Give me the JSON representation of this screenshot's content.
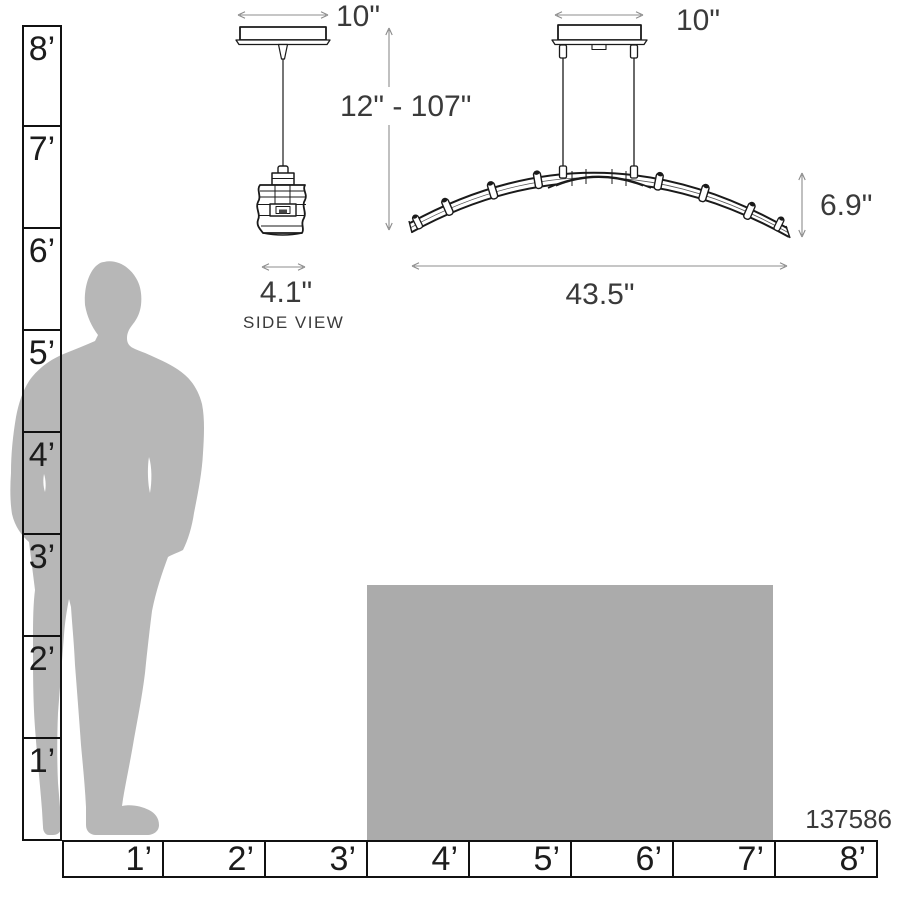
{
  "product": {
    "number": "137586"
  },
  "side_view": {
    "canopy_width_label": "10\"",
    "shade_width_label": "4.1\"",
    "caption": "SIDE VIEW"
  },
  "front_view": {
    "canopy_width_label": "10\"",
    "suspension_range_label": "12\" - 107\"",
    "fixture_width_label": "43.5\"",
    "fixture_height_label": "6.9\""
  },
  "vertical_ruler": {
    "unit": "feet",
    "labels": [
      "8’",
      "7’",
      "6’",
      "5’",
      "4’",
      "3’",
      "2’",
      "1’"
    ]
  },
  "horizontal_ruler": {
    "unit": "feet",
    "labels": [
      "1’",
      "2’",
      "3’",
      "4’",
      "5’",
      "6’",
      "7’",
      "8’"
    ]
  },
  "colors": {
    "background": "#ffffff",
    "drawing_line": "#1a1a1a",
    "dimension_line": "#8c8c8c",
    "text": "#3a3a3a",
    "ruler_border": "#111111",
    "silhouette": "#b7b7b7",
    "table_block": "#ababab"
  }
}
